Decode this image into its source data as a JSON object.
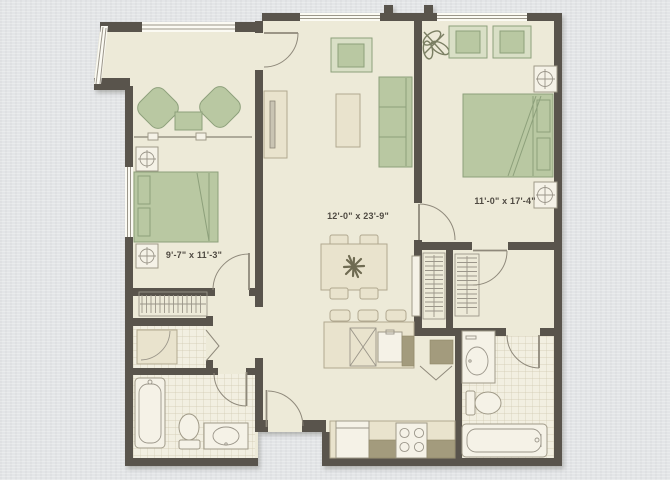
{
  "floorplan": {
    "type": "apartment-floor-plan",
    "rooms": [
      {
        "name": "living-dining-room",
        "dimensions": "12'-0\" x 23'-9\""
      },
      {
        "name": "master-bedroom",
        "dimensions": "11'-0\" x 17'-4\""
      },
      {
        "name": "bedroom-2",
        "dimensions": "9'-7\" x 11'-3\""
      }
    ],
    "palette": {
      "background_color": "#e3e5e7",
      "floor_color": "#edead8",
      "tile_floor_color": "#f2efe1",
      "wall_color": "#59544c",
      "furniture_green": "#b9c8a2",
      "green_stroke": "#8da07b",
      "furniture_tan": "#e9e3cd",
      "tan_stroke": "#b1a890",
      "counter_olive": "#a39b7d",
      "fixture_white": "#f5f2e7",
      "fixture_stroke": "#a09a88",
      "line_color": "#9b968a",
      "door_color": "#8f897b",
      "label_color": "#4f4a42"
    }
  }
}
